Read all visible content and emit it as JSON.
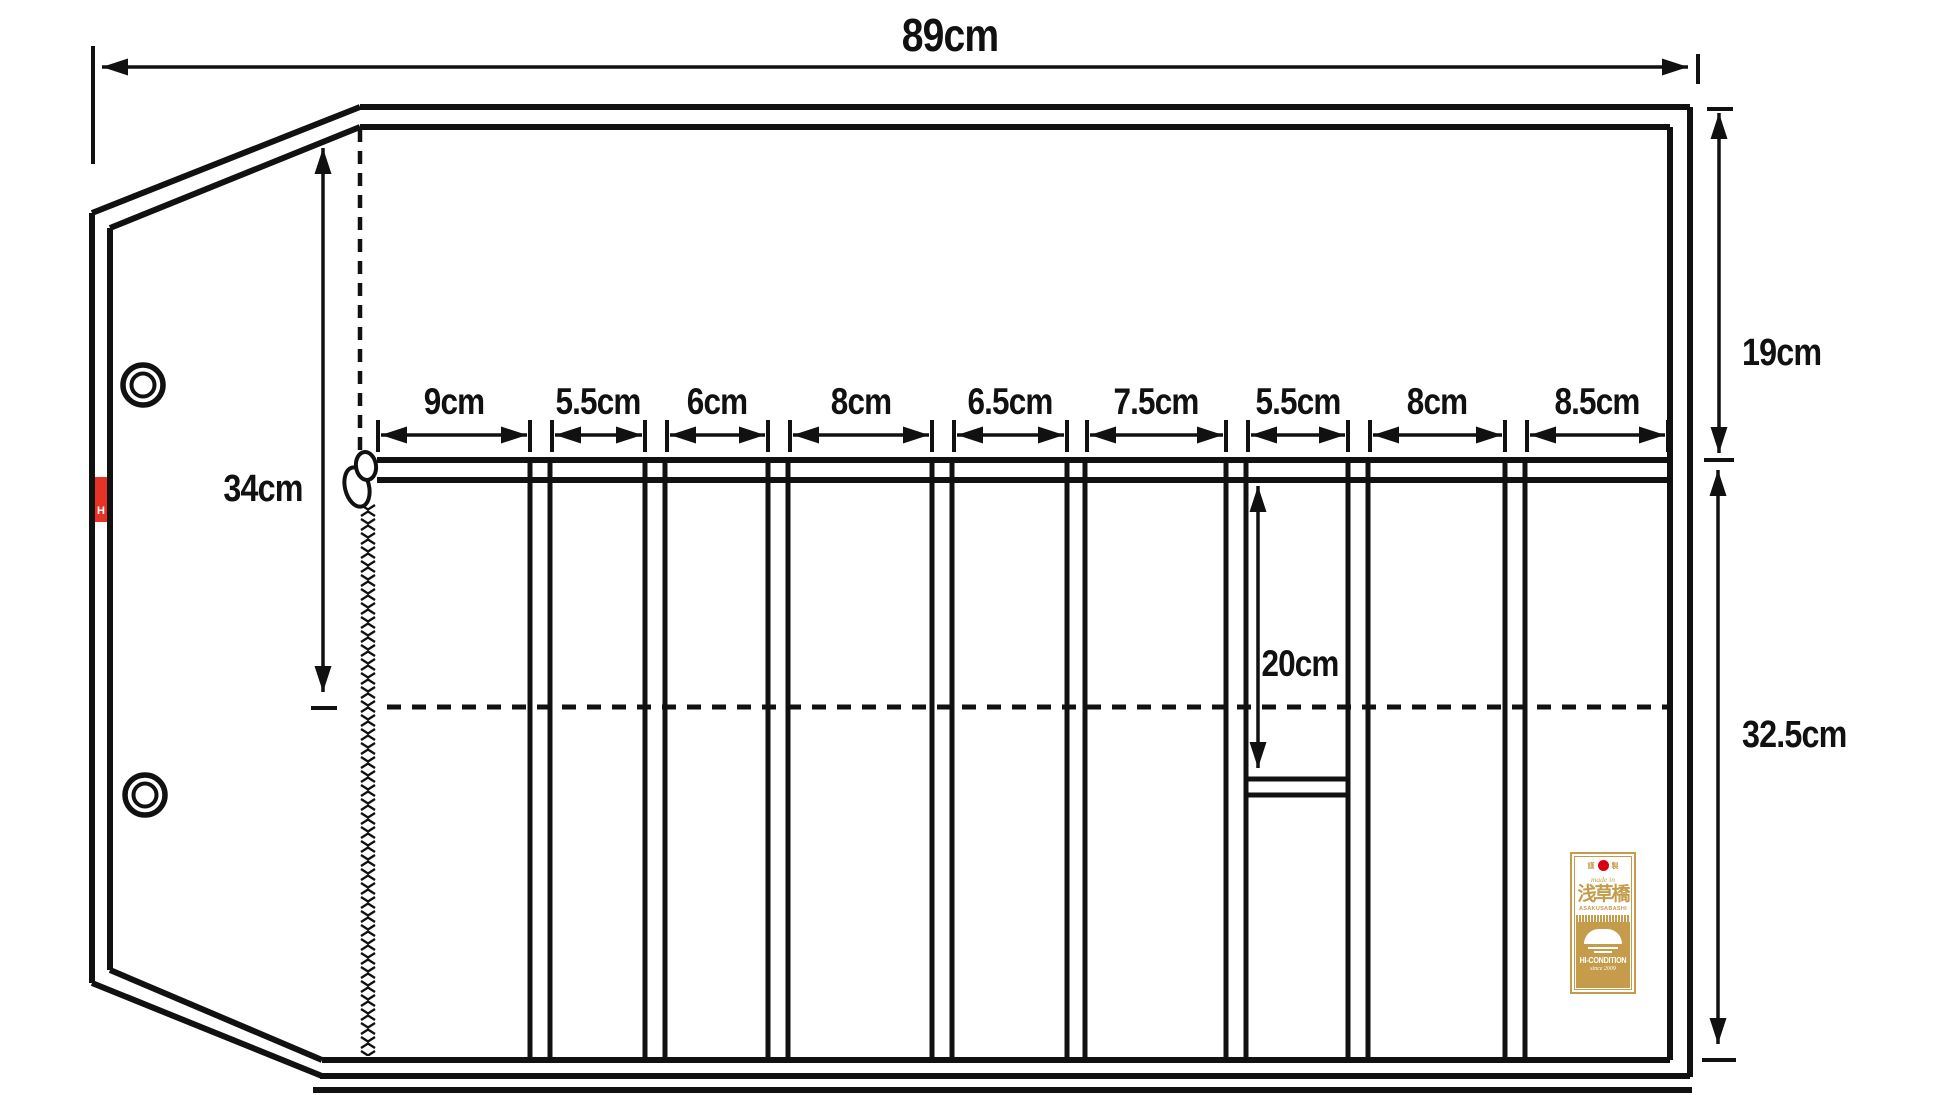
{
  "diagram": {
    "type": "knife-roll-dimension-diagram",
    "overall": {
      "width": "89cm",
      "flap_height": "34cm",
      "upper_flap_section": "19cm",
      "lower_pocket_section": "32.5cm",
      "small_pocket_depth": "20cm"
    },
    "pockets": [
      {
        "width": "9cm"
      },
      {
        "width": "5.5cm"
      },
      {
        "width": "6cm"
      },
      {
        "width": "8cm"
      },
      {
        "width": "6.5cm"
      },
      {
        "width": "7.5cm"
      },
      {
        "width": "5.5cm"
      },
      {
        "width": "8cm"
      },
      {
        "width": "8.5cm"
      }
    ]
  },
  "side_tag": {
    "letter": "H",
    "color": "#e63327"
  },
  "brand_label": {
    "seal_left": "謹",
    "seal_right": "製",
    "made_in": "made in",
    "kanji": "浅草橋",
    "romaji": "ASAKUSABASHI",
    "brand": "HI-CONDITION",
    "since": "since 2009",
    "gold_color": "#c49c4c",
    "flag_color": "#d8000f"
  },
  "colors": {
    "line": "#111111",
    "background": "#ffffff"
  }
}
